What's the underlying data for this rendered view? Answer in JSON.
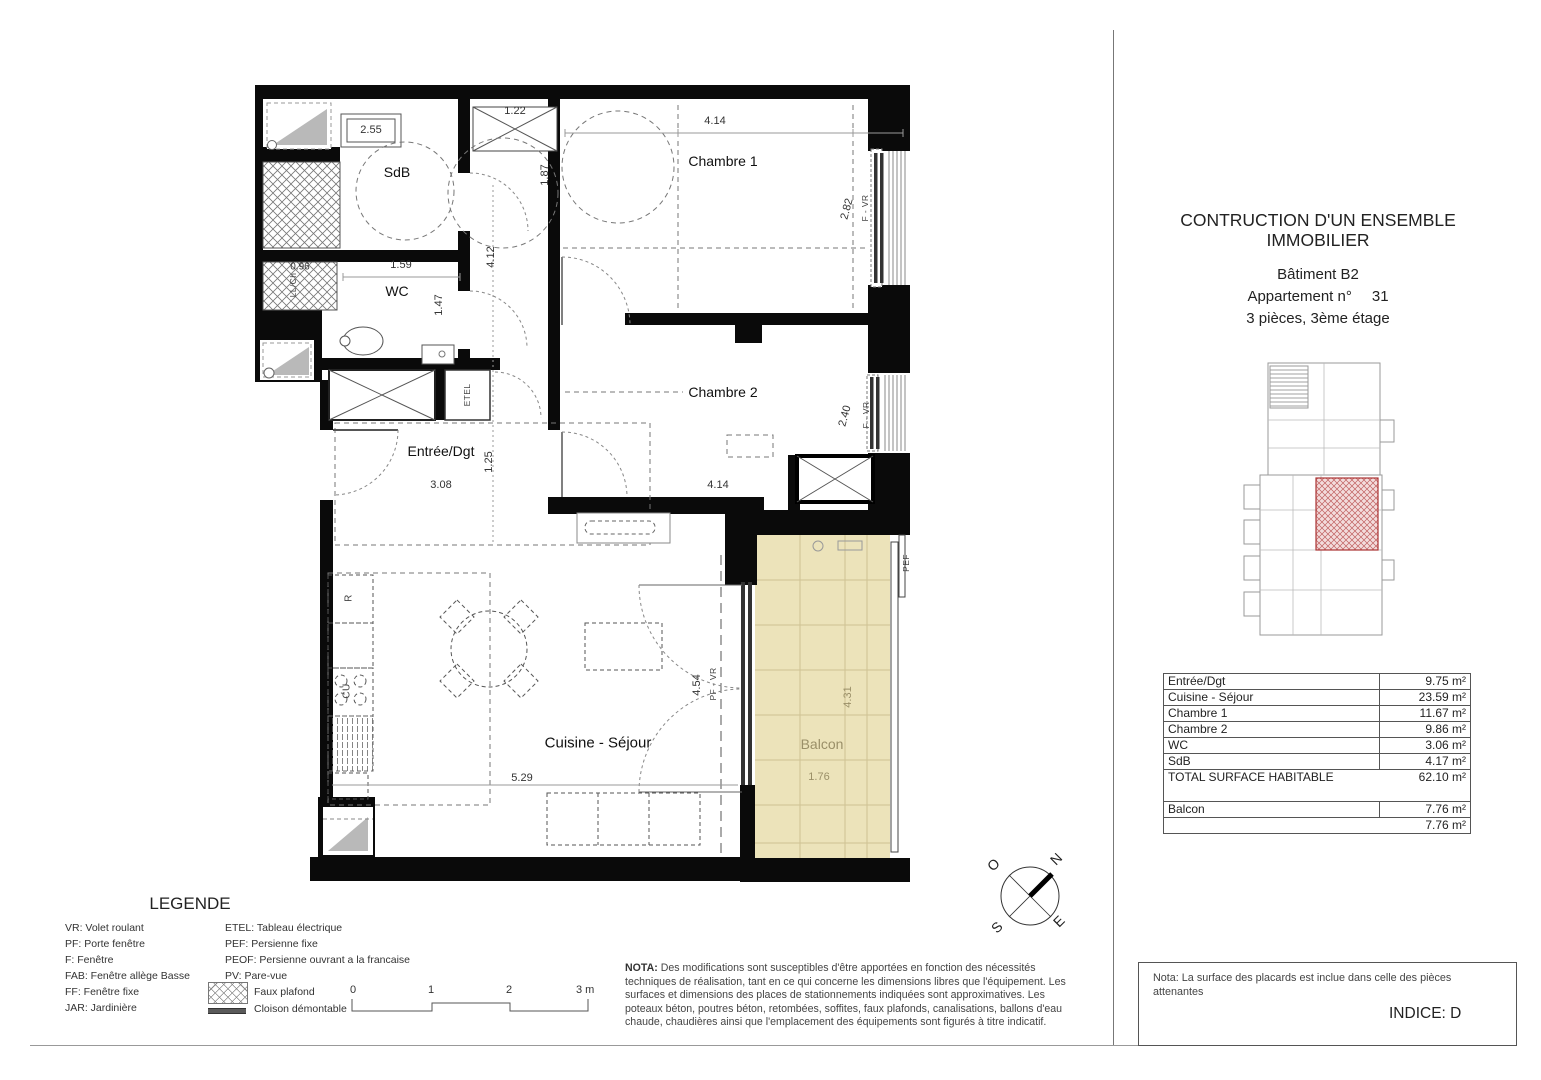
{
  "title_block": {
    "line1": "CONTRUCTION D'UN ENSEMBLE",
    "line2": "IMMOBILIER",
    "building": "Bâtiment B2",
    "apartment_label": "Appartement  n°",
    "apartment_number": "31",
    "floor_line": "3 pièces, 3ème  étage"
  },
  "surface_table": {
    "rows": [
      {
        "label": "Entrée/Dgt",
        "value": "9.75 m²"
      },
      {
        "label": "Cuisine - Séjour",
        "value": "23.59 m²"
      },
      {
        "label": "Chambre 1",
        "value": "11.67 m²"
      },
      {
        "label": "Chambre 2",
        "value": "9.86 m²"
      },
      {
        "label": "WC",
        "value": "3.06 m²"
      },
      {
        "label": "SdB",
        "value": "4.17 m²"
      }
    ],
    "total_label": "TOTAL SURFACE HABITABLE",
    "total_value": "62.10 m²",
    "balcon_label": "Balcon",
    "balcon_value": "7.76 m²",
    "balcon_total": "7.76 m²"
  },
  "plan": {
    "rooms": {
      "sdb": "SdB",
      "wc": "WC",
      "ch1": "Chambre 1",
      "ch2": "Chambre 2",
      "entree": "Entrée/Dgt",
      "sejour": "Cuisine - Séjour",
      "balcon": "Balcon"
    },
    "dims": {
      "d255": "2.55",
      "d122": "1.22",
      "d414t": "4.14",
      "d187": "1.87",
      "d282": "2.82",
      "d096": "0.96",
      "d159": "1.59",
      "d412": "4.12",
      "d147": "1.47",
      "d240": "2.40",
      "d125": "1.25",
      "d308": "3.08",
      "d414m": "4.14",
      "d454": "4.54",
      "d529": "5.29",
      "d431": "4.31",
      "d176": "1.76"
    },
    "tags": {
      "etel": "ETEL",
      "r": "R",
      "cu": "CU",
      "llch": "LL/Ch",
      "fvr1": "F - VR",
      "fvr2": "F - VR",
      "pfvr": "PF - VR",
      "pef": "PEF"
    },
    "compass": {
      "n": "N",
      "s": "S",
      "e": "E",
      "o": "O"
    }
  },
  "legend": {
    "title": "LEGENDE",
    "col1": [
      "VR: Volet roulant",
      "PF: Porte fenêtre",
      "F: Fenêtre",
      "FAB: Fenêtre allège Basse",
      "FF: Fenêtre fixe",
      "JAR: Jardinière"
    ],
    "col2": [
      "ETEL: Tableau électrique",
      "PEF: Persienne fixe",
      "PEOF: Persienne ouvrant a la francaise",
      "PV: Pare-vue"
    ],
    "faux_plafond": "Faux plafond",
    "cloison": "Cloison démontable"
  },
  "scalebar": {
    "labels": [
      "0",
      "1",
      "2",
      "3 m"
    ]
  },
  "nota": {
    "label": "NOTA:",
    "text": "Des modifications sont susceptibles d'être apportées en fonction des nécessités techniques de réalisation, tant en ce qui concerne les dimensions libres que l'équipement. Les surfaces et dimensions des places de stationnements indiquées sont approximatives. Les poteaux béton, poutres béton, retombées, soffites, faux plafonds, canalisations, ballons d'eau chaude, chaudières ainsi que l'emplacement des équipements sont figurés à titre indicatif."
  },
  "footer": {
    "note": "Nota: La surface des placards est inclue dans celle des pièces attenantes",
    "indice": "INDICE: D"
  },
  "colors": {
    "balcony_fill": "#ece3ba",
    "apartment_highlight": "#bb4444",
    "wall": "#0a0a0a"
  }
}
